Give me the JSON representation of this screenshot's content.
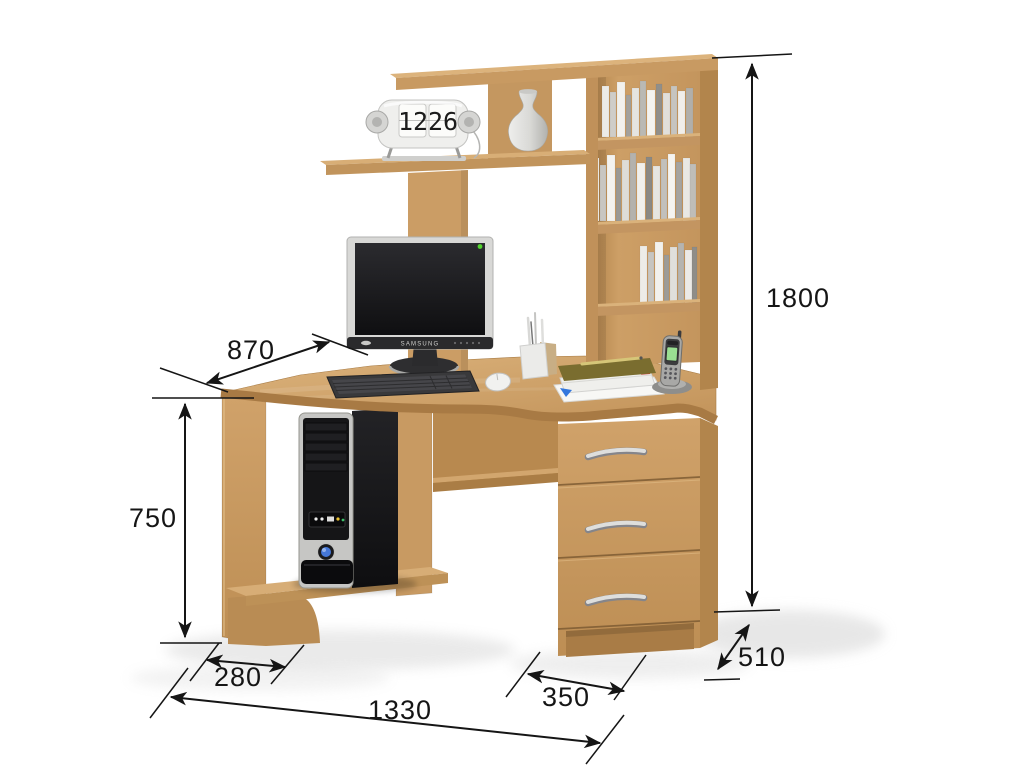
{
  "dimensions": {
    "desk_edge": {
      "label": "870"
    },
    "overall_height": {
      "label": "1800"
    },
    "desk_height": {
      "label": "750"
    },
    "shelf_width": {
      "label": "280"
    },
    "overall_width": {
      "label": "1330"
    },
    "pedestal_width": {
      "label": "350"
    },
    "depth": {
      "label": "510"
    }
  },
  "clock": {
    "hours": "12",
    "minutes": "26"
  },
  "monitor": {
    "brand": "SAMSUNG"
  },
  "colors": {
    "wood": "#cda06a",
    "wood_dark": "#b2854c",
    "wood_light": "#dab47e",
    "dimension_line": "#151515",
    "monitor_led_green": "#52d42e",
    "pc_power_blue": "#4577d8",
    "background": "#ffffff"
  }
}
